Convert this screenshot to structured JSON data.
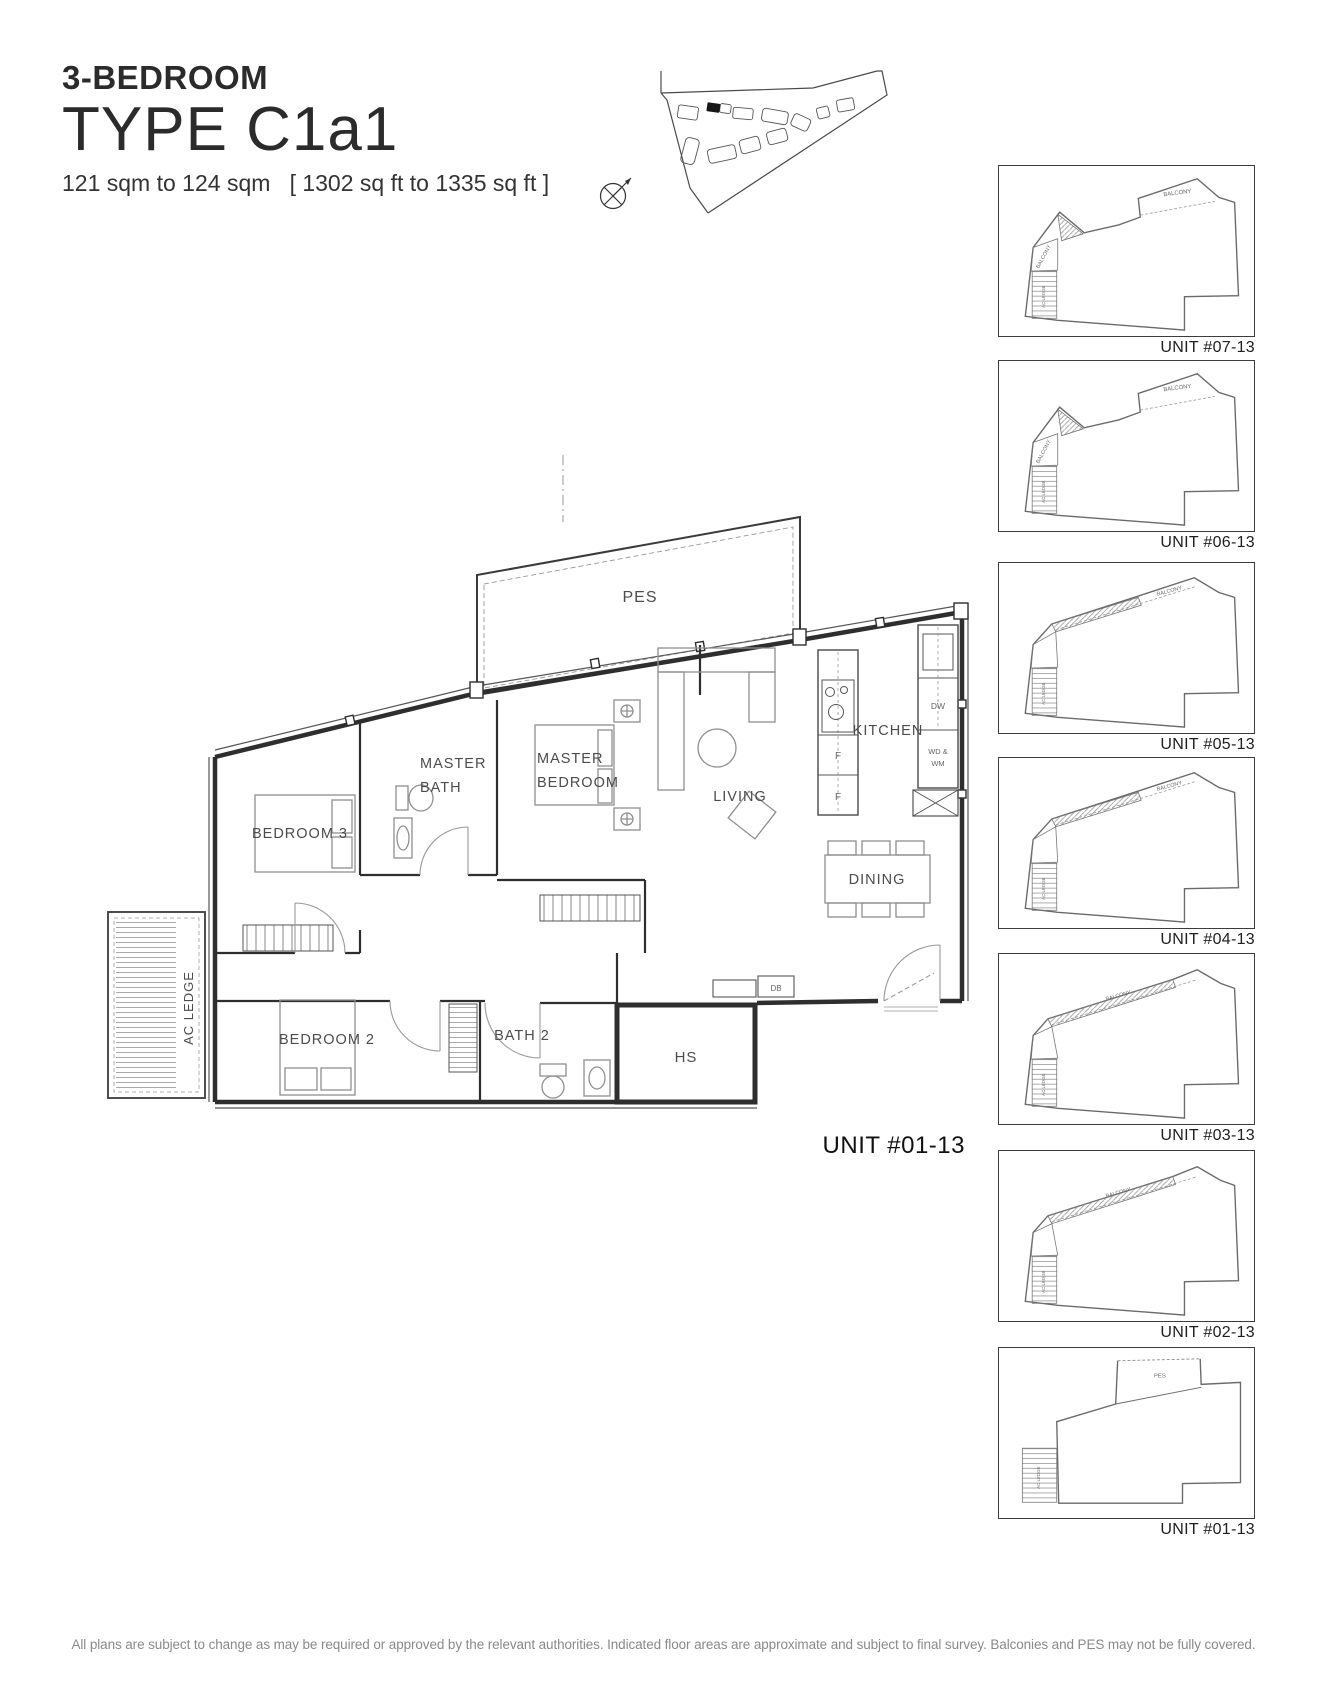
{
  "header": {
    "type_label": "3-BEDROOM",
    "type_code": "TYPE C1a1",
    "area_text": "121 sqm to 124 sqm   [ 1302 sq ft to 1335 sq ft ]"
  },
  "floor_plan": {
    "labels": {
      "pes": "PES",
      "master_bath": [
        "MASTER",
        "BATH"
      ],
      "master_bedroom": [
        "MASTER",
        "BEDROOM"
      ],
      "bedroom3": "BEDROOM 3",
      "living": "LIVING",
      "kitchen": "KITCHEN",
      "dining": "DINING",
      "ac_ledge": "AC LEDGE",
      "bedroom2": "BEDROOM 2",
      "bath2": "BATH 2",
      "hs": "HS",
      "db": "DB",
      "fridge1": "F",
      "fridge2": "F",
      "dw": "DW",
      "wd_wm": [
        "WD &",
        "WM"
      ]
    },
    "unit_label": "UNIT #01-13"
  },
  "unit_stack": {
    "mini_labels": {
      "balcony": "BALCONY",
      "ac_ledge": "AC LEDGE",
      "pes": "PES"
    },
    "units": [
      {
        "label": "UNIT #07-13",
        "symbol": "#mini-a"
      },
      {
        "label": "UNIT #06-13",
        "symbol": "#mini-a"
      },
      {
        "label": "UNIT #05-13",
        "symbol": "#mini-b"
      },
      {
        "label": "UNIT #04-13",
        "symbol": "#mini-b"
      },
      {
        "label": "UNIT #03-13",
        "symbol": "#mini-c"
      },
      {
        "label": "UNIT #02-13",
        "symbol": "#mini-c"
      },
      {
        "label": "UNIT #01-13",
        "symbol": "#mini-pes"
      }
    ]
  },
  "footer": {
    "disclaimer": "All plans are subject to change as may be required or approved by the relevant authorities. Indicated floor areas are approximate and subject to final survey. Balconies and PES may not be fully covered."
  },
  "colors": {
    "wall": "#2e2e2e",
    "furniture": "#8f8f8f",
    "label": "#4c4c4c",
    "title": "#2b2b2b",
    "disclaimer": "#8a8a8a"
  }
}
